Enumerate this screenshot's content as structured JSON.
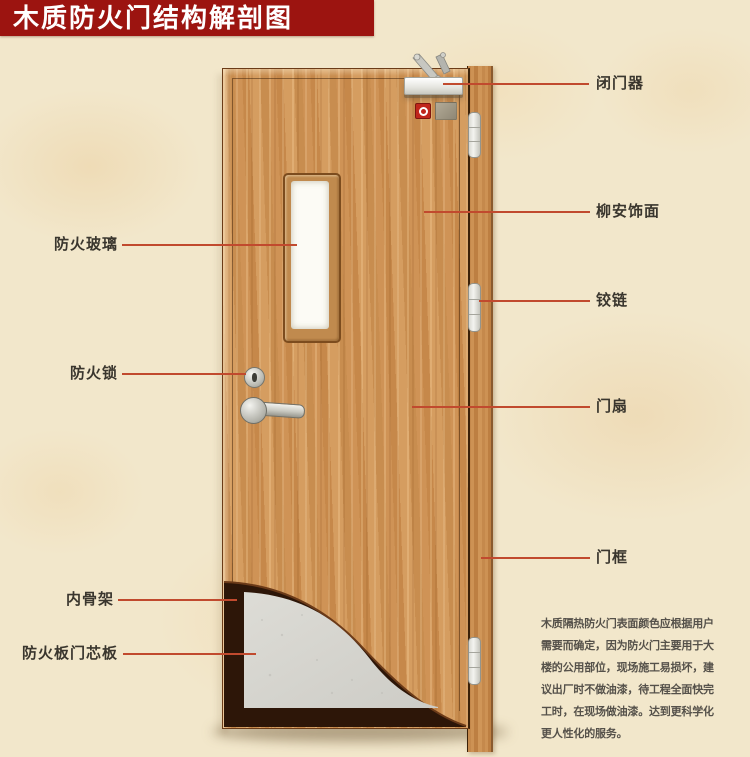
{
  "title": "木质防火门结构解剖图",
  "labels": {
    "right": [
      {
        "text": "闭门器"
      },
      {
        "text": "柳安饰面"
      },
      {
        "text": "铰链"
      },
      {
        "text": "门扇"
      },
      {
        "text": "门框"
      }
    ],
    "left": [
      {
        "text": "防火玻璃"
      },
      {
        "text": "防火锁"
      },
      {
        "text": "内骨架"
      },
      {
        "text": "防火板门芯板"
      }
    ]
  },
  "description": "木质隔热防火门表面颜色应根据用户\n需要而确定，因为防火门主要用于大\n楼的公用部位，现场施工易损坏，建\n议出厂时不做油漆，待工程全面快完\n工时，在现场做油漆。达到更科学化\n更人性化的服务。",
  "colors": {
    "banner_red": "#9c1410",
    "leader_line_red": "#c14a2e",
    "door_wood": "#cb9154",
    "core_board_gray": "#d8d7d1",
    "inner_frame_brown": "#2d1608",
    "label_text": "#3a362e"
  }
}
